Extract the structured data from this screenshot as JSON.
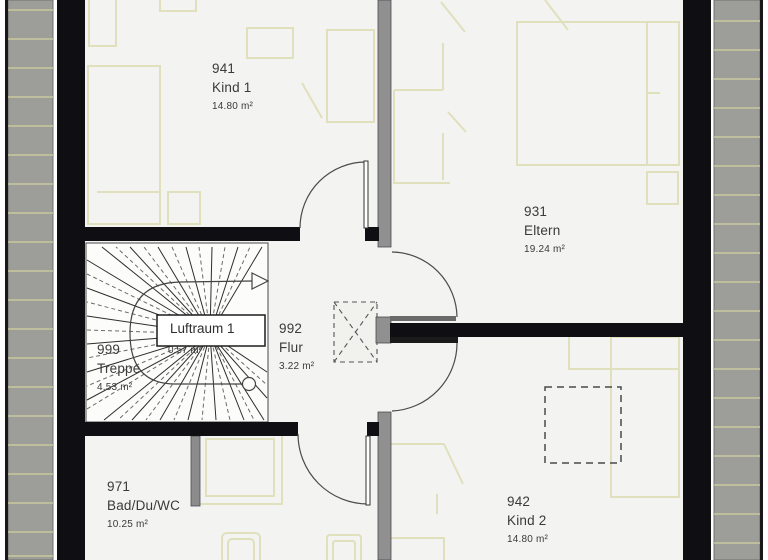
{
  "plan": {
    "rooms": [
      {
        "number": "941",
        "name": "Kind 1",
        "area": "14.80 m²"
      },
      {
        "number": "931",
        "name": "Eltern",
        "area": "19.24 m²"
      },
      {
        "number": "999",
        "name": "Treppe",
        "area": "4.53 m²"
      },
      {
        "number": "992",
        "name": "Flur",
        "area": "3.22 m²"
      },
      {
        "number": "971",
        "name": "Bad/Du/WC",
        "area": "10.25 m²"
      },
      {
        "number": "942",
        "name": "Kind 2",
        "area": "14.80 m²"
      }
    ],
    "void_label": {
      "name": "Luftraum 1",
      "area": "0.57 m²"
    },
    "colors": {
      "exterior_wall": "#0e0e13",
      "partition_wall": "#909090",
      "roof_surface": "#9d9d99",
      "roof_hatch_line": "#c9c99e",
      "floor": "#f3f3f1",
      "stair_floor": "#fcfcfa",
      "furniture_line": "#e0e0bd",
      "door_arc": "#4a4a4a",
      "text": "#3a3a3a"
    }
  }
}
